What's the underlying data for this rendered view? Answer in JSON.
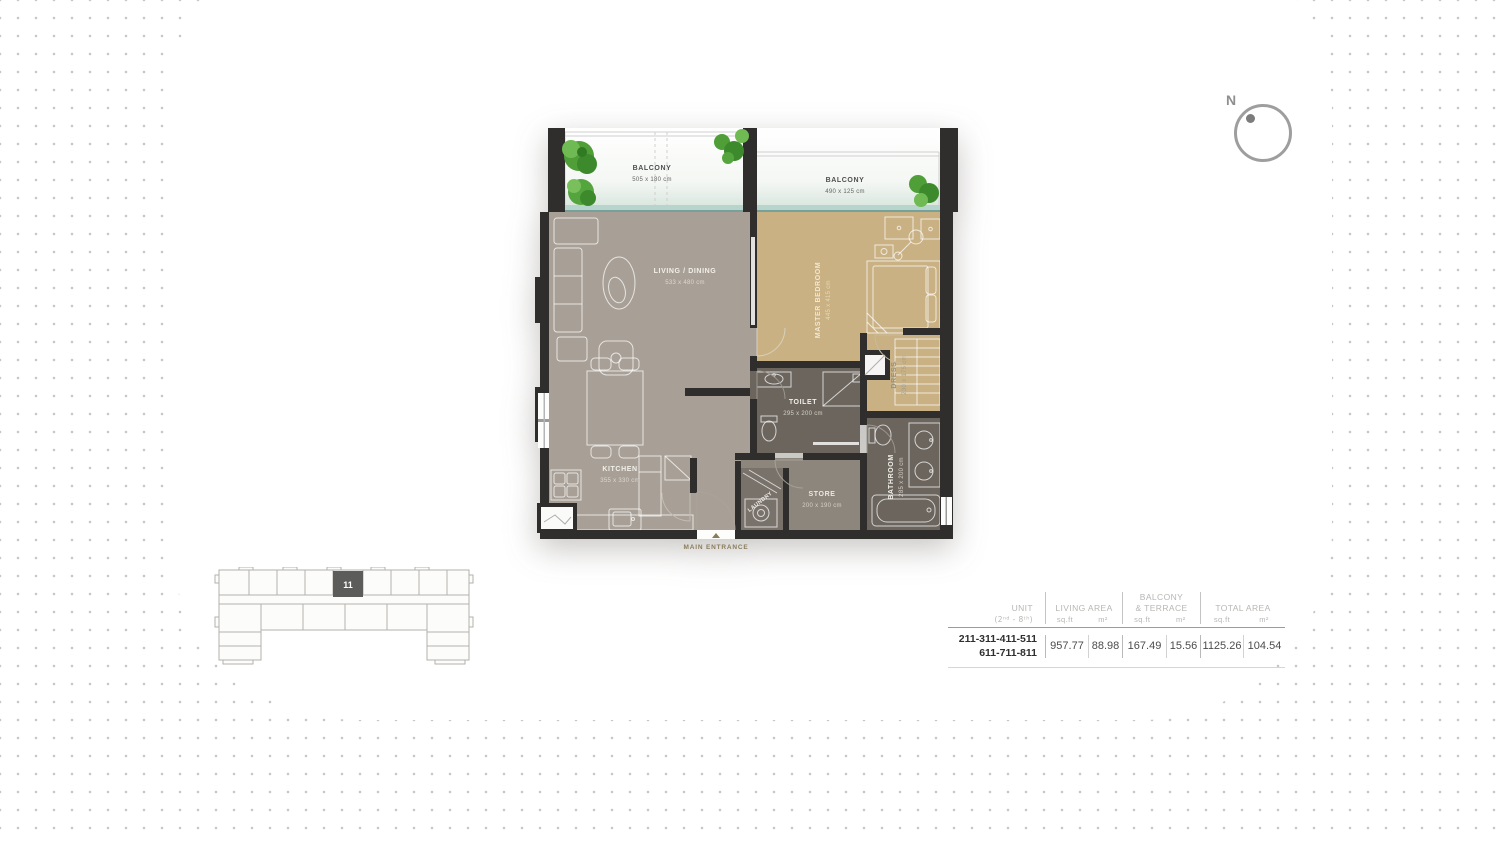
{
  "compass": {
    "label": "N"
  },
  "floor_plan": {
    "balcony_left": {
      "name": "BALCONY",
      "dims": "505 x 180 cm"
    },
    "balcony_right": {
      "name": "BALCONY",
      "dims": "490 x 125 cm"
    },
    "living_dining": {
      "name": "LIVING / DINING",
      "dims": "533 x 480 cm"
    },
    "master_bedroom": {
      "name": "MASTER BEDROOM",
      "dims": "445 x 415 cm"
    },
    "kitchen": {
      "name": "KITCHEN",
      "dims": "355 x 330 cm"
    },
    "toilet": {
      "name": "TOILET",
      "dims": "295 x 200 cm"
    },
    "store": {
      "name": "STORE",
      "dims": "200 x 190 cm"
    },
    "laundry": {
      "name": "LAUNDRY"
    },
    "dress": {
      "name": "DRESS",
      "dims": "230 x 175 cm"
    },
    "bathroom": {
      "name": "BATHROOM",
      "dims": "285 x 200 cm"
    },
    "main_entrance": {
      "label": "MAIN ENTRANCE"
    },
    "colors": {
      "wall": "#2f2e2c",
      "floor_living": "#a8a097",
      "floor_bedroom": "#c9b183",
      "floor_wet": "#6b655e",
      "floor_store": "#8d867d",
      "glass": "#b7d4cd",
      "tree_green": "#4f9e38",
      "entrance_accent": "#8a7c5a"
    }
  },
  "keyplan": {
    "unit_number": "11",
    "highlight_color": "#5c5c5a"
  },
  "area_table": {
    "header": {
      "unit_label": "UNIT",
      "unit_range": "(2ⁿᵈ - 8ᵗʰ)",
      "living_label": "LIVING AREA",
      "balcony_label_1": "BALCONY",
      "balcony_label_2": "& TERRACE",
      "total_label": "TOTAL AREA",
      "sqft": "sq.ft",
      "m2": "m²"
    },
    "row": {
      "unit_line1": "211-311-411-511",
      "unit_line2": "611-711-811",
      "living_sqft": "957.77",
      "living_m2": "88.98",
      "balcony_sqft": "167.49",
      "balcony_m2": "15.56",
      "total_sqft": "1125.26",
      "total_m2": "104.54"
    }
  }
}
